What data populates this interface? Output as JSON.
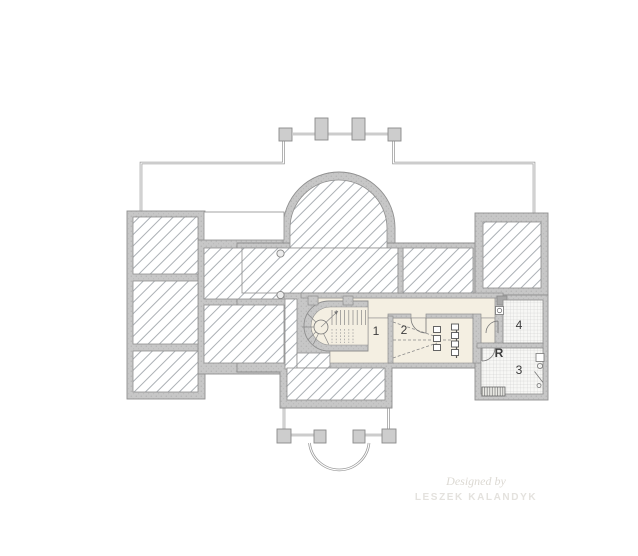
{
  "page": {
    "title": "Floor plan drawing"
  },
  "rooms": [
    {
      "id": "room-1",
      "label": "1"
    },
    {
      "id": "room-2",
      "label": "2"
    },
    {
      "id": "room-4",
      "label": "4"
    },
    {
      "id": "room-r",
      "label": "R"
    },
    {
      "id": "room-3",
      "label": "3"
    }
  ],
  "watermark": {
    "line1": "Designed by",
    "line2": "LESZEK KALANDYK"
  },
  "colors": {
    "wall": "#c7c7c7",
    "wall_edge": "#8f8f8f",
    "hatch_line": "#a2a7ad",
    "outline": "#9a9a9a",
    "interior": "#f4efe2",
    "tile_bg": "#f7f7f5",
    "tile_line": "#c9c9c9",
    "label": "#3c3c3c",
    "watermark": "#dcd9d3"
  }
}
